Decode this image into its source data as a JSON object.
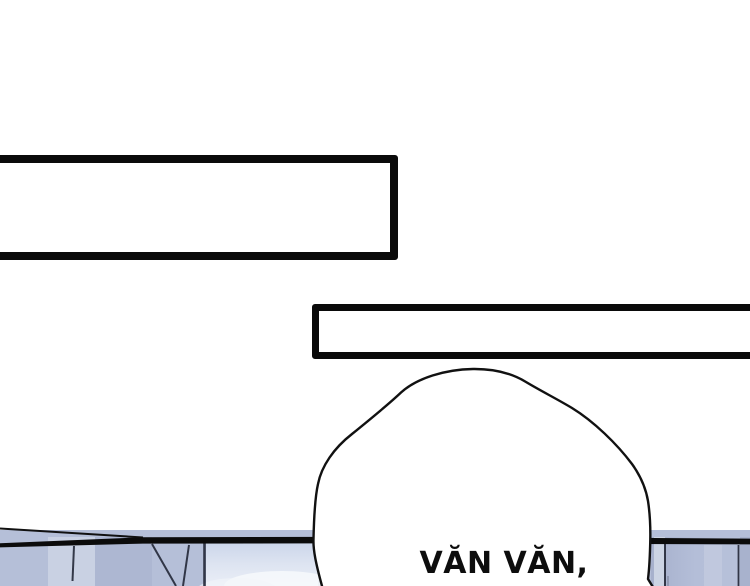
{
  "panel": {
    "dialogue": {
      "text": "VĂN VĂN,"
    },
    "caption_boxes": [
      {
        "text": ""
      },
      {
        "text": ""
      }
    ],
    "colors": {
      "line_art": "#0b0b0b",
      "background": "#ffffff",
      "window_blue": "#b5bfd8",
      "window_blue_light": "#c9d1e3",
      "window_blue_dark": "#adb7d2",
      "sky_pane": "#e7ecf6",
      "right_pane": "#b2bcd6"
    }
  }
}
